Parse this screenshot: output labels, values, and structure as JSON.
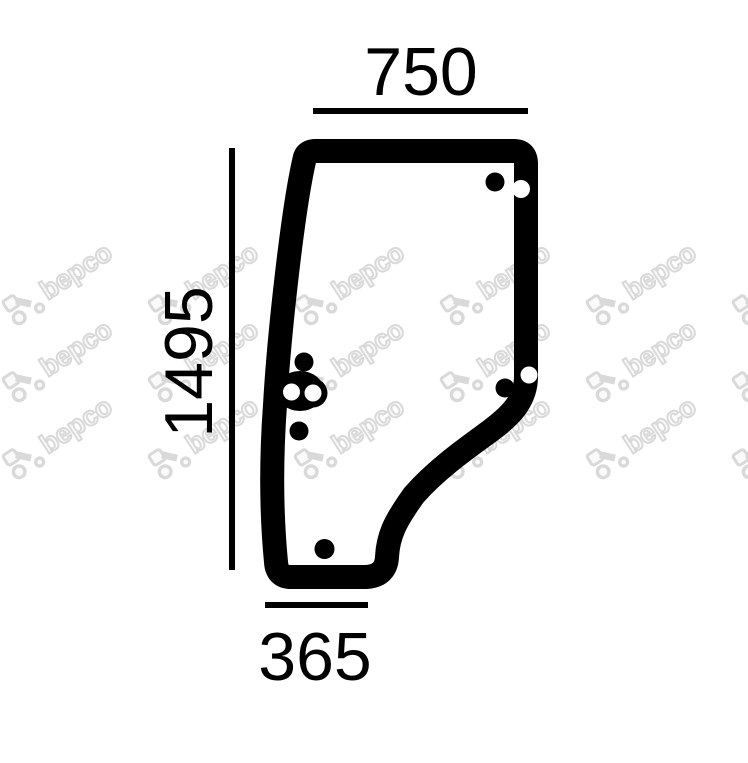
{
  "page": {
    "background": "#ffffff"
  },
  "drawing": {
    "kind": "door-glass-outline-drawing",
    "dimension_labels": {
      "top": "750",
      "left": "1495",
      "bottom": "365"
    },
    "watermark_text": "bepco",
    "colors": {
      "ink": "#000000",
      "watermark": "#d9d9d9"
    }
  }
}
